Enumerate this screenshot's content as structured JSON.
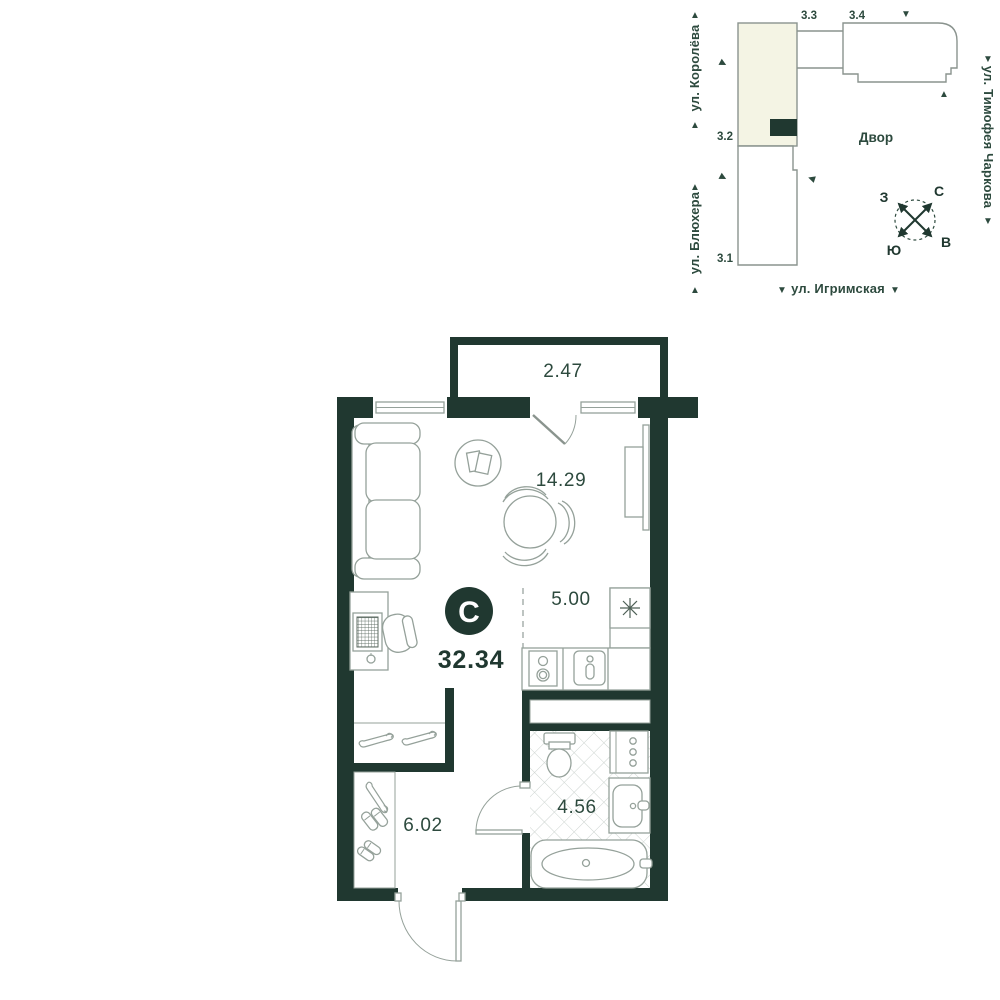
{
  "site_plan": {
    "streets": [
      {
        "id": "koroleva",
        "name": "ул. Королёва"
      },
      {
        "id": "blyukhera",
        "name": "ул. Блюхера"
      },
      {
        "id": "charkova",
        "name": "ул. Тимофея Чаркова"
      },
      {
        "id": "igrimskaya",
        "name": "ул. Игримская"
      }
    ],
    "buildings": [
      {
        "id": "3.3",
        "label": "3.3"
      },
      {
        "id": "3.4",
        "label": "3.4"
      },
      {
        "id": "3.2",
        "label": "3.2",
        "highlighted": true
      },
      {
        "id": "3.1",
        "label": "3.1"
      }
    ],
    "courtyard_label": "Двор",
    "compass": {
      "north": "С",
      "south": "Ю",
      "west": "З",
      "east": "В"
    }
  },
  "floor_plan": {
    "total_area": "32.34",
    "logo_letter": "С",
    "rooms": [
      {
        "id": "balcony",
        "area": "2.47"
      },
      {
        "id": "living-room",
        "area": "14.29"
      },
      {
        "id": "kitchen",
        "area": "5.00"
      },
      {
        "id": "hallway",
        "area": "6.02"
      },
      {
        "id": "bathroom",
        "area": "4.56"
      }
    ]
  },
  "icons": {
    "arrow_up": "▲",
    "arrow_down": "▼",
    "arrow_left": "◀",
    "arrow_right": "▶",
    "fridge": "snowflake-icon",
    "compass": "compass-rose-icon"
  },
  "colors": {
    "wall": "#203830",
    "accent_text": "#2d4a3e",
    "highlight_building_fill": "#f4f4e4",
    "furniture_stroke": "#95a19a",
    "tile_line": "#ccd3cf"
  }
}
